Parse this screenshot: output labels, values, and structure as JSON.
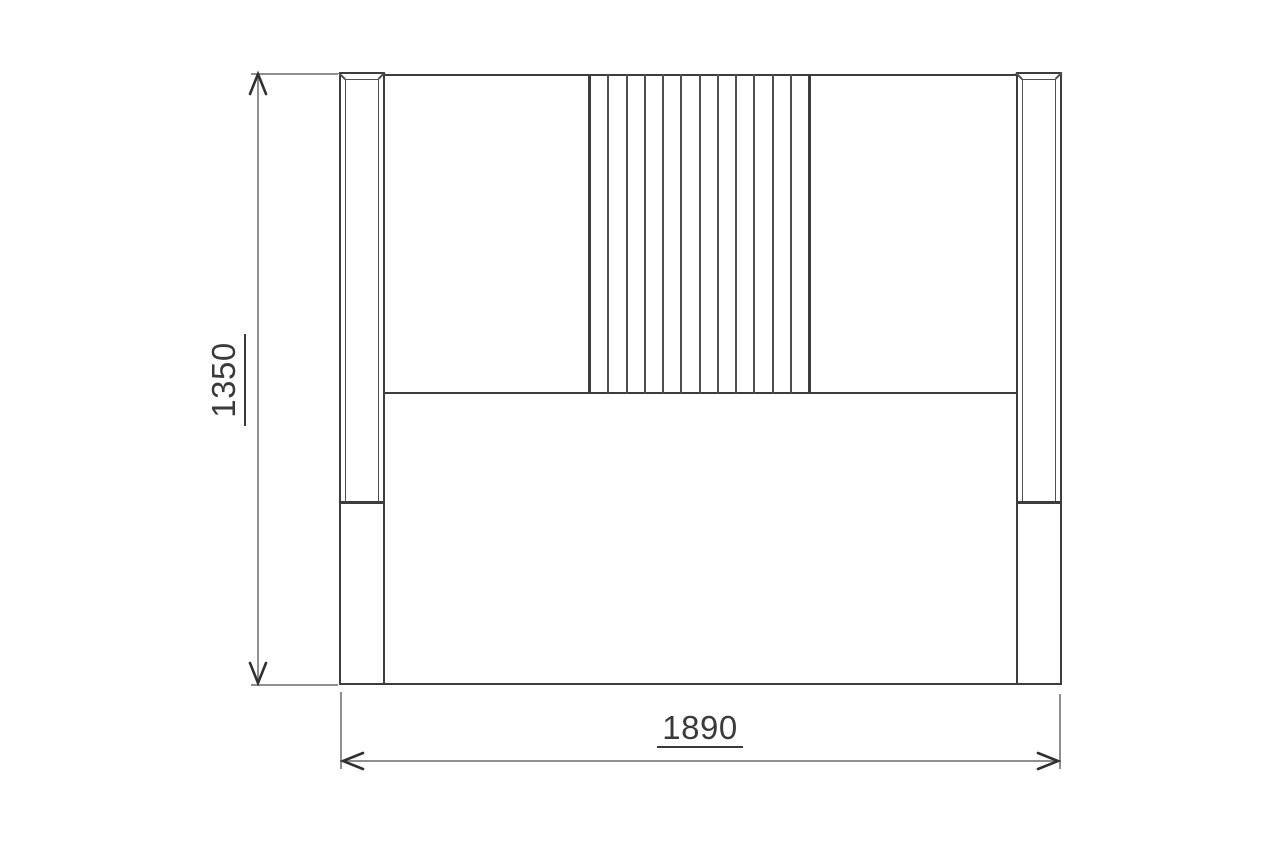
{
  "drawing": {
    "type": "furniture-front-elevation-technical-drawing",
    "dimension_labels": {
      "height": "1350",
      "width": "1890"
    },
    "slat_count": 12,
    "colors": {
      "background": "#ffffff",
      "outline": "#3d3d3d",
      "inner_line": "#4f4f4f",
      "dimension_line": "#8f8f8f",
      "arrow": "#303030",
      "text": "#3a3a3a"
    }
  }
}
